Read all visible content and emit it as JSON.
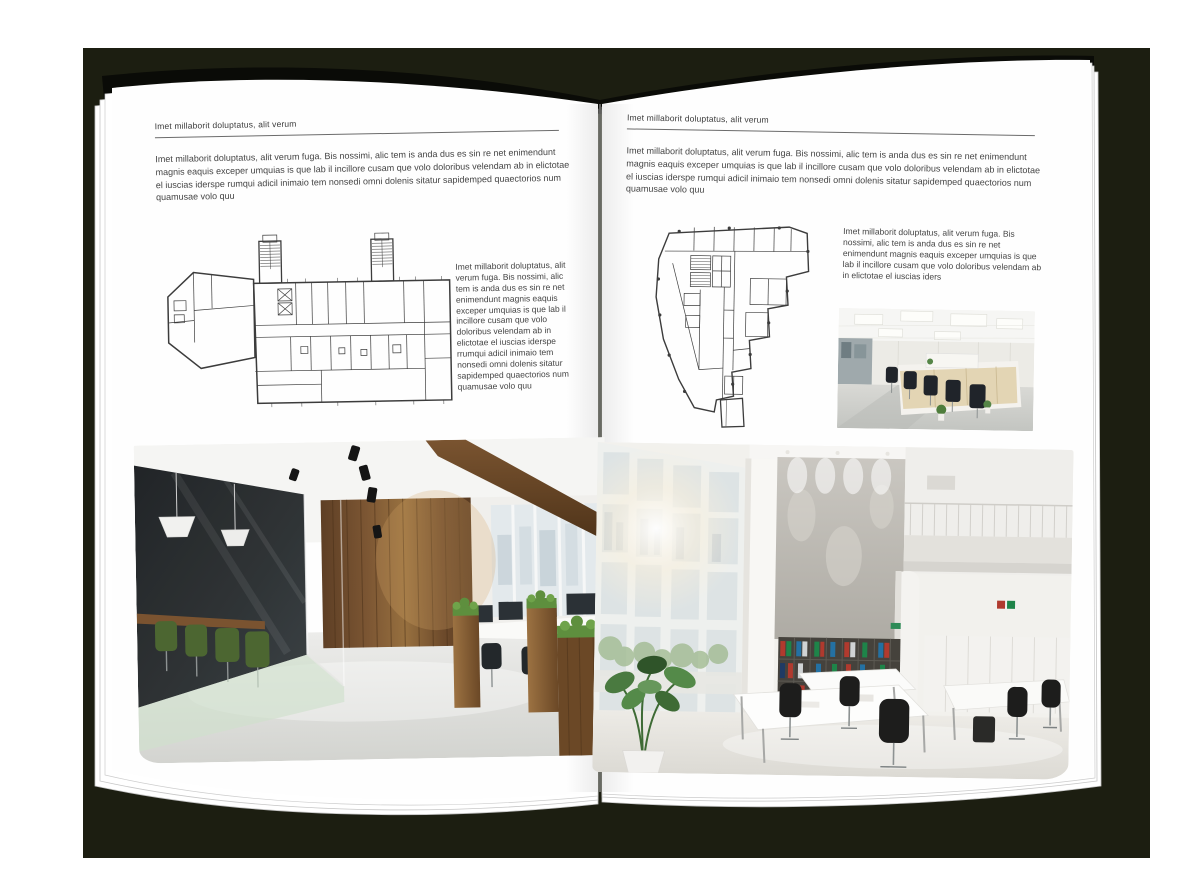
{
  "scene": {
    "background_color": "#ffffff",
    "backdrop_color": "#1c1e11",
    "page_color": "#fefefe",
    "ink_color": "#3f3f3f"
  },
  "left_page": {
    "header": "Imet millaborit doluptatus, alit verum",
    "intro": "Imet millaborit doluptatus, alit verum fuga. Bis nossimi, alic tem is anda dus es sin re net enimendunt magnis eaquis exceper umquias is que lab il incillore cusam que volo doloribus velendam ab in elictotae el iuscias iderspe rumqui adicil inimaio tem nonsedi omni dolenis sitatur sapidemped quaectorios num quamusae volo quu",
    "side_text": "Imet millaborit doluptatus, alit verum fuga. Bis nossimi, alic tem is anda dus es sin re net enimendunt magnis eaquis exceper umquias is que lab il incillore cusam que volo doloribus velendam ab in elictotae el iuscias iderspe rrumqui adicil inimaio tem nonsedi omni dolenis sitatur sapidemped quaectorios num quamusae volo quu",
    "floor_plan": "rectangular building floor plan with two stair towers and left wing",
    "photo": "loft office interior with dark glass meeting room, green chairs, wooden plank wall, planters and workstations"
  },
  "right_page": {
    "header": "Imet millaborit doluptatus, alit verum",
    "intro": "Imet millaborit doluptatus, alit verum fuga. Bis nossimi, alic tem is anda dus es sin re net enimendunt magnis eaquis exceper umquias is que lab il incillore cusam que volo doloribus velendam ab in elictotae el iuscias iderspe rumqui adicil inimaio tem nonsedi omni dolenis sitatur sapidemped quaectorios num quamusae volo quu",
    "side_text": "Imet millaborit doluptatus, alit verum fuga. Bis nossimi, alic tem is anda dus es sin re net enimendunt magnis eaquis exceper umquias is que lab il incillore cusam que volo doloribus velendam ab in elictotae el iuscias iders",
    "floor_plan": "irregular tapering floor plan with stepped right edge and bottom stub",
    "photo_small": "open office with cubicle workstations, light wood cabinets and black chairs",
    "photo_large": "double-height white office atrium with window wall, concrete feature wall, binder shelves and white desks"
  }
}
